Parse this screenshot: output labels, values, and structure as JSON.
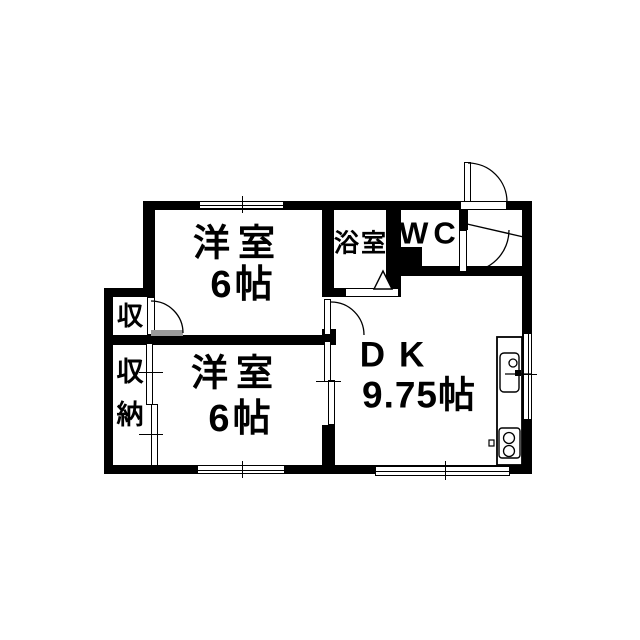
{
  "title": "apartment-floorplan",
  "rooms": {
    "west_room_1": {
      "name": "洋室",
      "size": "6帖"
    },
    "west_room_2": {
      "name": "洋室",
      "size": "6帖"
    },
    "dining_kitchen": {
      "name": "DK",
      "size": "9.75帖"
    },
    "bathroom": {
      "name": "浴室"
    },
    "toilet": {
      "name": "WC"
    },
    "closet_small": {
      "name": "収"
    },
    "closet": {
      "name": "収納"
    }
  },
  "fixtures": {
    "kitchen_sink": "sink-icon",
    "kitchen_stove": "two-burner-stove-icon",
    "bath_folding_door": "triangle-door-icon",
    "entry_door": "swing-door-icon",
    "wc_door": "swing-door-icon",
    "windows": "double-line-window",
    "sliding_doors": "double-panel-slider"
  },
  "colors": {
    "wall": "#000000",
    "background": "#ffffff",
    "threshold_gray": "#999999"
  }
}
